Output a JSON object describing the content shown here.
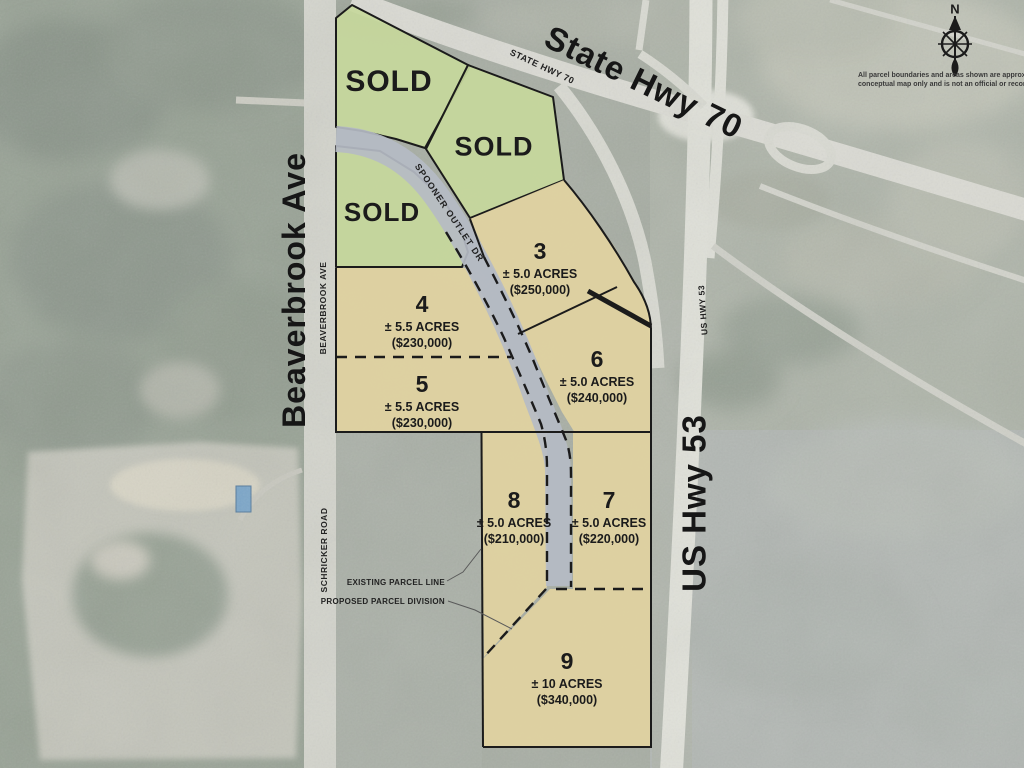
{
  "map_type": "conceptual real-estate parcel map over aerial photo",
  "roads": {
    "state_hwy_70_large": "State Hwy 70",
    "state_hwy_70_small": "STATE HWY 70",
    "beaverbrook_large": "Beaverbrook Ave",
    "beaverbrook_small": "BEAVERBROOK AVE",
    "us_hwy_53_large": "US Hwy 53",
    "us_hwy_53_small": "US HWY 53",
    "spooner_outlet_dr": "SPOONER OUTLET DR",
    "schricker_road": "SCHRICKER ROAD"
  },
  "sold": {
    "label1": "SOLD",
    "label2": "SOLD",
    "label3": "SOLD"
  },
  "parcels": [
    {
      "number": "3",
      "acres": "± 5.0 ACRES",
      "price": "($250,000)"
    },
    {
      "number": "4",
      "acres": "± 5.5 ACRES",
      "price": "($230,000)"
    },
    {
      "number": "5",
      "acres": "± 5.5 ACRES",
      "price": "($230,000)"
    },
    {
      "number": "6",
      "acres": "± 5.0 ACRES",
      "price": "($240,000)"
    },
    {
      "number": "7",
      "acres": "± 5.0 ACRES",
      "price": "($220,000)"
    },
    {
      "number": "8",
      "acres": "± 5.0 ACRES",
      "price": "($210,000)"
    },
    {
      "number": "9",
      "acres": "± 10 ACRES",
      "price": "($340,000)"
    }
  ],
  "legend": {
    "existing": "EXISTING PARCEL LINE",
    "proposed": "PROPOSED PARCEL DIVISION"
  },
  "compass": {
    "north": "N"
  },
  "disclaimer": {
    "line1": "All parcel boundaries and areas shown are approximate.",
    "line2": "conceptual map only and is not an official or recorded su"
  },
  "colors": {
    "sold_parcel_fill": "#c7d89c",
    "available_parcel_fill": "#e0d2a0",
    "boundary_line": "#1b1b1b",
    "proposed_road_overlay": "#b5bbc4",
    "aerial_base": "#a7ada3",
    "aerial_road": "#dcdcd5"
  }
}
